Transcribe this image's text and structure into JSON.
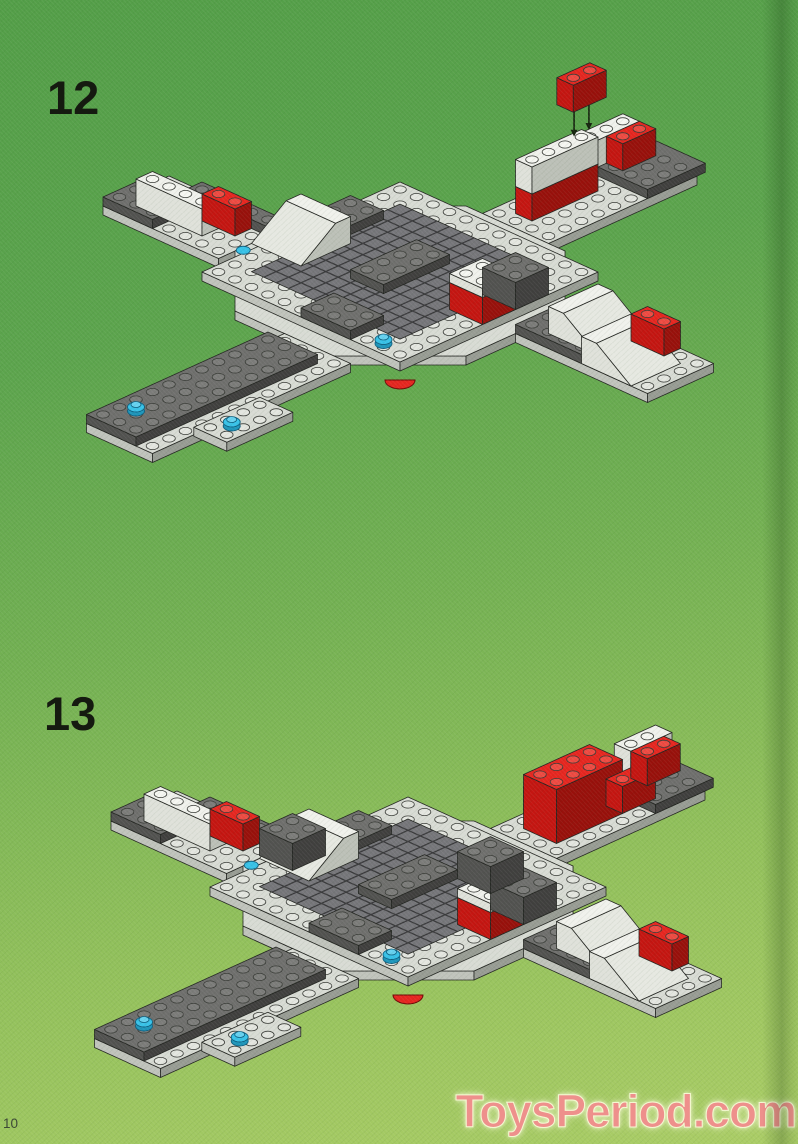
{
  "page": {
    "page_number": "10",
    "watermark": "ToysPeriod.com"
  },
  "steps": [
    {
      "label": "12",
      "callout_part": "red-1x2-brick",
      "callout_arrows": 2
    },
    {
      "label": "13"
    }
  ],
  "palette": {
    "background_green_top": "#58a14b",
    "background_green_bottom": "#a9cb64",
    "step_number_color": "#151a10",
    "watermark_pink": "#ee908c",
    "brick_red": "#e62620",
    "brick_light_gray": "#d8dbd4",
    "brick_dark_gray": "#6f6f6d",
    "brick_white": "#f0f1ec",
    "accent_cyan": "#38c2e8",
    "mesh_gray": "#76767a"
  }
}
